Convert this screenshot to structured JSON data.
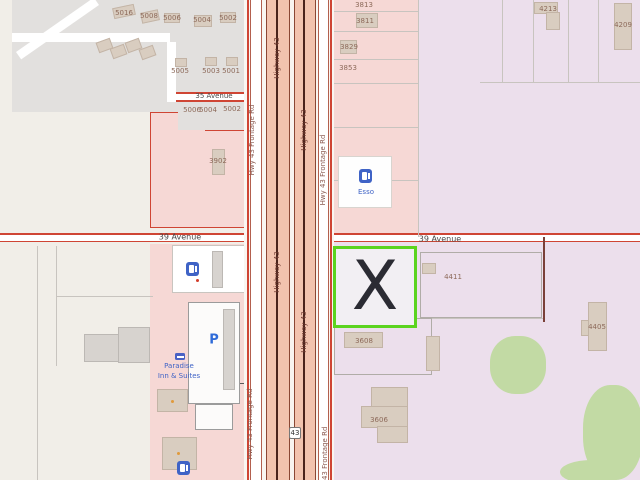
{
  "streets": {
    "avenue_35": "35 Avenue",
    "avenue_39": "39 Avenue",
    "highway_43": "Highway 43",
    "frontage": "Hwy 43 Frontage Rd",
    "shield_43": "43"
  },
  "marker": {
    "glyph": "X"
  },
  "pois": {
    "fuel_brand": "Esso",
    "parking": "P",
    "hotel_name_line1": "Paradise",
    "hotel_name_line2": "Inn & Suites"
  },
  "housenumbers": {
    "h5016": "5016",
    "h5008": "5008",
    "h5006a": "5006",
    "h5004a": "5004",
    "h5002a": "5002",
    "h5005": "5005",
    "h5003": "5003",
    "h5001": "5001",
    "h5006b": "5006",
    "h5004b": "5004",
    "h5002b": "5002",
    "h3902": "3902",
    "h3813": "3813",
    "h3811": "3811",
    "h3829": "3829",
    "h3853": "3853",
    "h4213": "4213",
    "h4209": "4209",
    "h4411": "4411",
    "h4405": "4405",
    "h3608": "3608",
    "h3606": "3606"
  },
  "colors": {
    "marker_border": "#5bd41f",
    "marker_x": "#2b2b33",
    "highway_fill": "#f2c3ae",
    "highway_casing": "#8a4734",
    "road_red": "#cf4534",
    "pink_zone": "#f6d8d5",
    "lavender_zone": "#ecdfec",
    "residential_gray": "#e2e0de",
    "beige_base": "#f1eee8",
    "building_tan": "#d9cdc0",
    "grass_green": "#c2daa4",
    "poi_blue": "#3f63c6"
  }
}
